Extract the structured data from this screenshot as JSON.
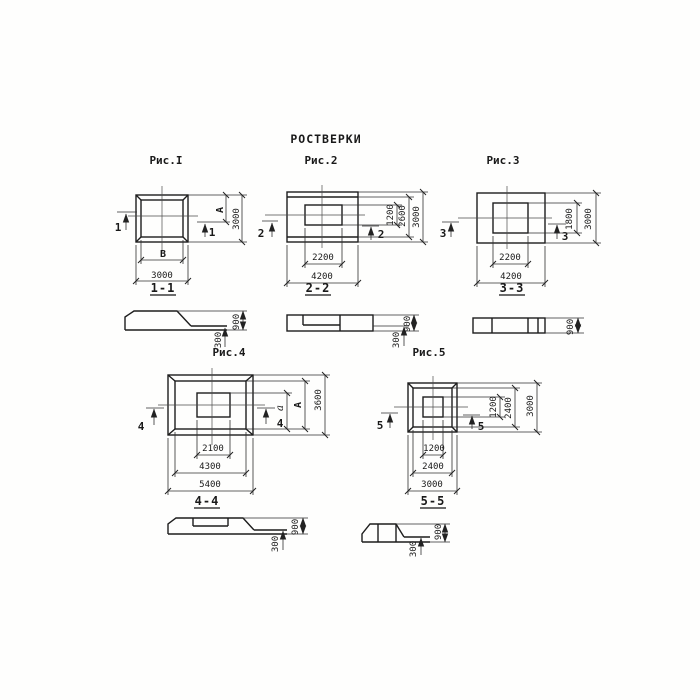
{
  "title": "РОСТВЕРКИ",
  "figures": {
    "fig1": {
      "label": "Рис.I",
      "cut": "1",
      "section_label": "1-1",
      "dim_bottom": "3000",
      "dim_right": "3000",
      "letter_width": "В",
      "letter_height": "А",
      "sec_total": "900",
      "sec_edge": "300"
    },
    "fig2": {
      "label": "Рис.2",
      "cut": "2",
      "section_label": "2-2",
      "dims_bottom": [
        "2200",
        "4200"
      ],
      "dims_right": [
        "1200",
        "2600",
        "3000"
      ],
      "sec_total": "900",
      "sec_edge": "300"
    },
    "fig3": {
      "label": "Рис.3",
      "cut": "3",
      "section_label": "3-3",
      "dims_bottom": [
        "2200",
        "4200"
      ],
      "dims_right": [
        "1800",
        "3000"
      ],
      "sec_total": "900"
    },
    "fig4": {
      "label": "Рис.4",
      "cut": "4",
      "section_label": "4-4",
      "dims_bottom": [
        "2100",
        "4300",
        "5400"
      ],
      "letters_right": [
        "а",
        "А"
      ],
      "dim_right": "3600",
      "sec_total": "900",
      "sec_edge": "300"
    },
    "fig5": {
      "label": "Рис.5",
      "cut": "5",
      "section_label": "5-5",
      "dims_bottom": [
        "1200",
        "2400",
        "3000"
      ],
      "dims_right": [
        "1200",
        "2400",
        "3000"
      ],
      "sec_total": "900",
      "sec_edge": "300"
    }
  }
}
